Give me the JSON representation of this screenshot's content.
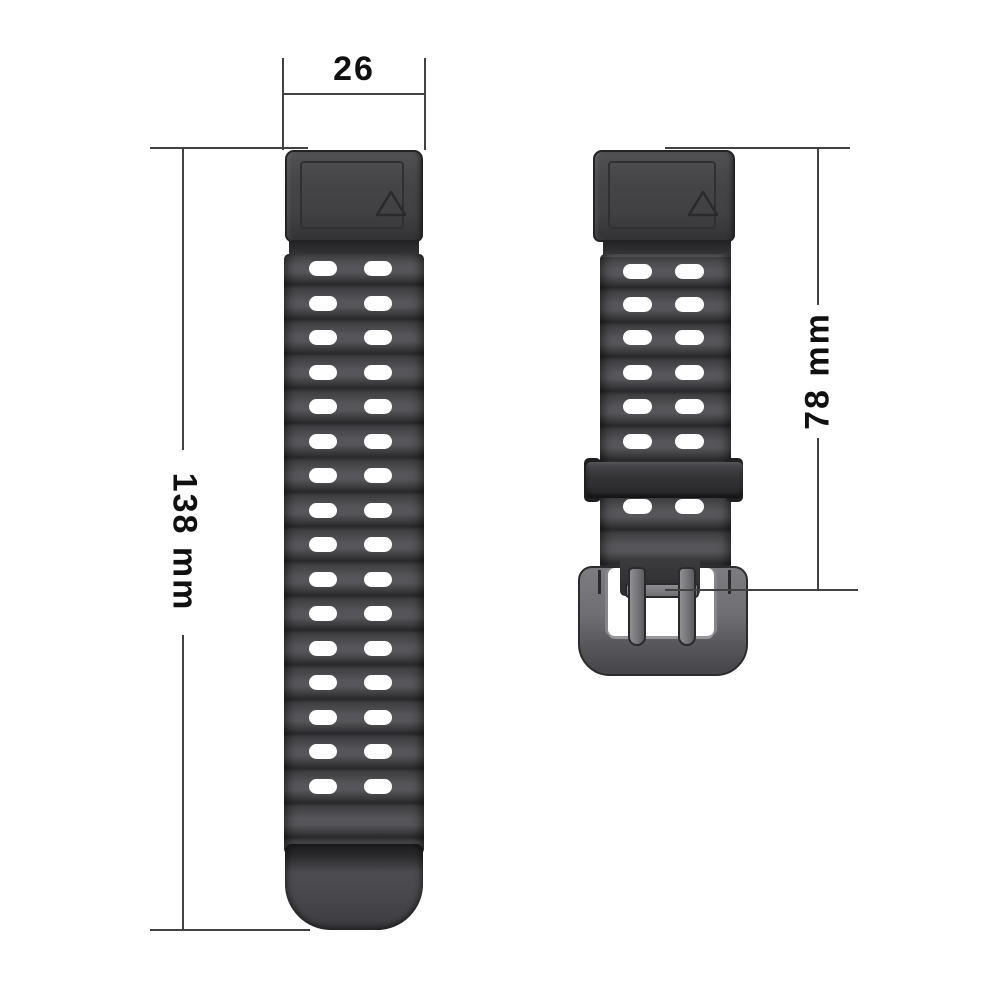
{
  "product": {
    "type": "watch-band-dimension-diagram"
  },
  "labels": {
    "band_width_mm": "26",
    "long_strap_length": "138 mm",
    "short_strap_length": "78 mm"
  },
  "colors": {
    "background": "#ffffff",
    "strap_base": "#454548",
    "stripe_light": "#56565a",
    "stripe_mid": "#3f3f42",
    "stripe_dark": "#28282b",
    "end_piece_face": "#47474a",
    "outline": "#232325",
    "hole": "#ffffff",
    "keeper": "#353538",
    "metal_light": "#8e8e92",
    "metal_mid": "#6e6e72",
    "metal_dark": "#46464a",
    "dimension_line": "#414141",
    "label_text": "#101010"
  },
  "left_strap": {
    "hole_columns_x": [
      25,
      80
    ],
    "hole_row_tops": [
      7,
      42,
      76,
      111,
      145,
      180,
      214,
      249,
      283,
      318,
      352,
      387,
      421,
      456,
      490,
      525
    ],
    "hole_width": 28,
    "hole_height": 15
  },
  "right_strap": {
    "hole_columns_x": [
      23,
      75
    ],
    "hole_row_tops": [
      10,
      43,
      76,
      111,
      145,
      180,
      245
    ],
    "hole_width": 29,
    "hole_height": 15
  }
}
